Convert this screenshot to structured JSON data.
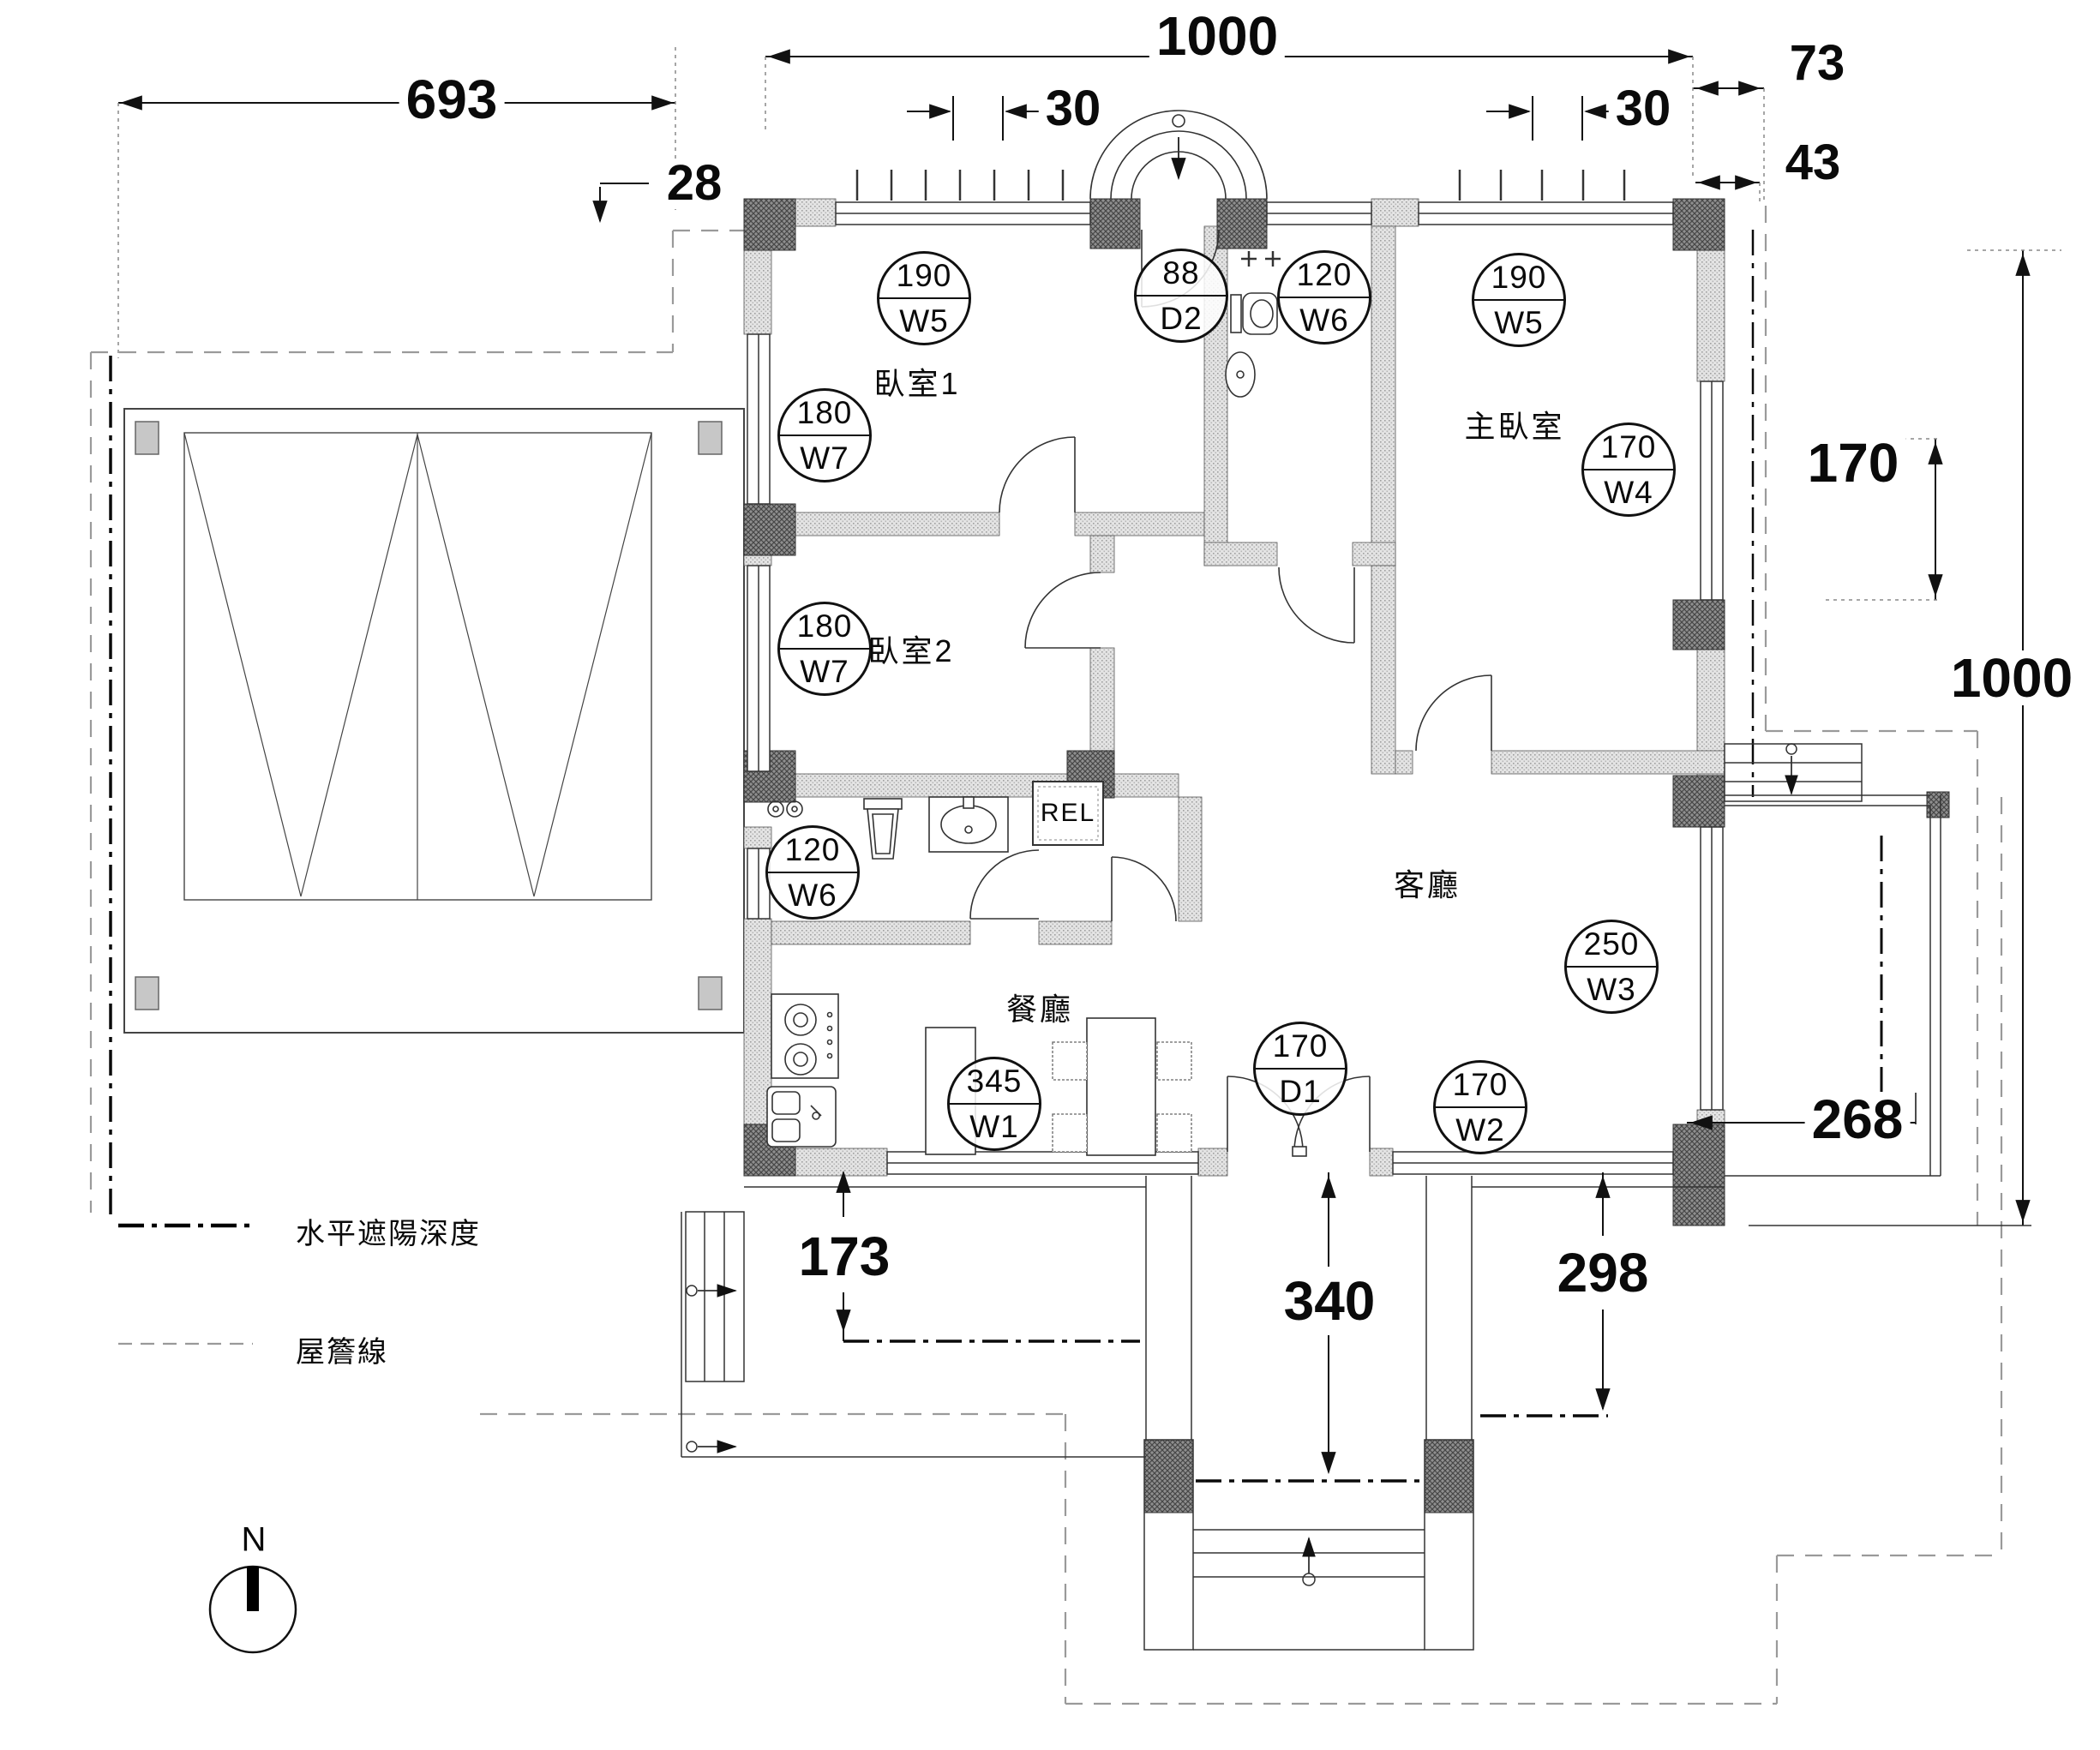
{
  "dimensions": {
    "top_width": "1000",
    "right_offset_upper": "73",
    "right_offset_lower": "43",
    "top_inset_left": "30",
    "top_inset_right": "30",
    "deck_width": "693",
    "eave_offset": "28",
    "window_w4_height": "170",
    "right_height": "1000",
    "patio_width": "268",
    "porch_left_offset": "173",
    "entry_offset": "340",
    "terrace_offset": "298"
  },
  "tags": [
    {
      "size": "190",
      "code": "W5"
    },
    {
      "size": "180",
      "code": "W7"
    },
    {
      "size": "88",
      "code": "D2"
    },
    {
      "size": "120",
      "code": "W6"
    },
    {
      "size": "190",
      "code": "W5"
    },
    {
      "size": "170",
      "code": "W4"
    },
    {
      "size": "180",
      "code": "W7"
    },
    {
      "size": "120",
      "code": "W6"
    },
    {
      "size": "345",
      "code": "W1"
    },
    {
      "size": "170",
      "code": "D1"
    },
    {
      "size": "170",
      "code": "W2"
    },
    {
      "size": "250",
      "code": "W3"
    }
  ],
  "rooms": [
    {
      "name": "臥室1"
    },
    {
      "name": "主臥室"
    },
    {
      "name": "臥室2"
    },
    {
      "name": "客廳"
    },
    {
      "name": "餐廳"
    }
  ],
  "labels": {
    "rel": "REL",
    "north": "N"
  },
  "legend": [
    {
      "label": "水平遮陽深度"
    },
    {
      "label": "屋簷線"
    }
  ]
}
